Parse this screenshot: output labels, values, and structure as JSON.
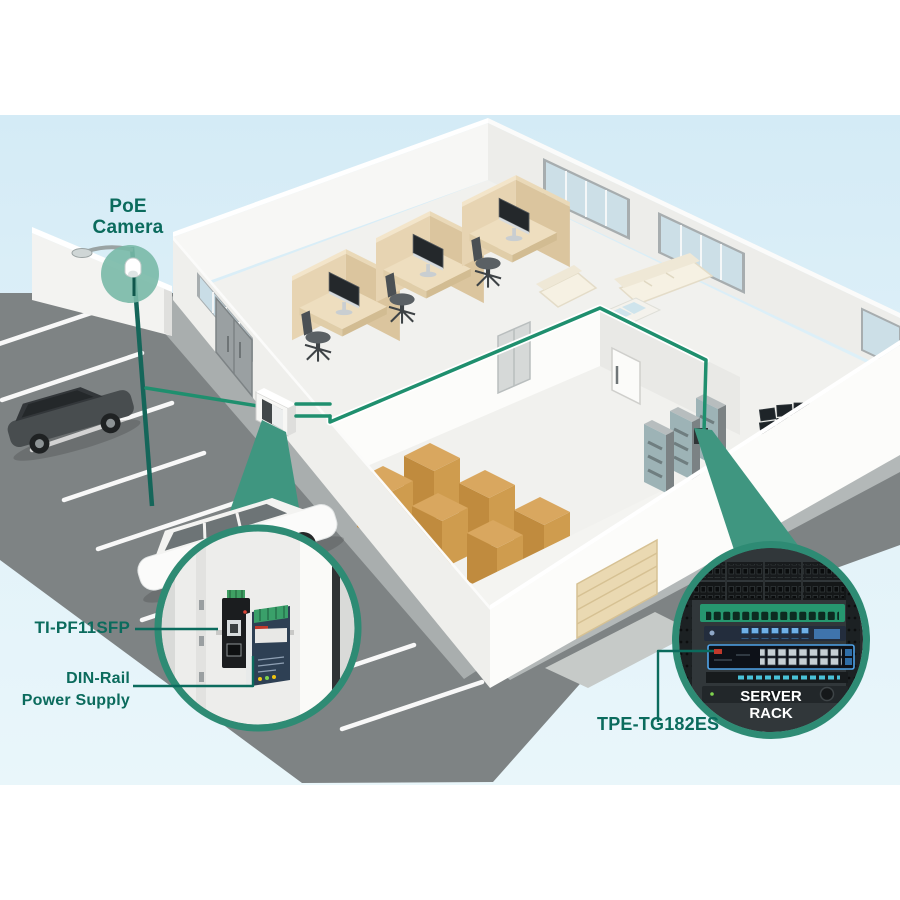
{
  "labels": {
    "camera": {
      "line1": "PoE",
      "line2": "Camera"
    },
    "fiber_converter": "TI-PF11SFP",
    "power_supply": {
      "line1": "DIN-Rail",
      "line2": "Power Supply"
    },
    "switch": "TPE-TG182ES",
    "rack": {
      "line1": "SERVER",
      "line2": "RACK"
    }
  },
  "colors": {
    "accent_cable": "#1f8f6e",
    "label_text": "#0b6b5d",
    "callout_ring": "#2e8b74",
    "cone": "#3f9680",
    "camera_halo": "#79b9a7",
    "sky": "#d8eef7",
    "street": "#7e8384",
    "carton_box": "#cf9c4e",
    "cubicle_panel": "#e7d4b2",
    "switch_highlight": "#4fa3e8",
    "rack_patch_green": "#26976f"
  },
  "icons": {
    "camera": "dome-camera-icon",
    "converter": "fiber-media-converter-icon",
    "psu": "din-rail-power-supply-icon",
    "rack": "server-rack-icon"
  },
  "scene_objects": [
    "parking lot with cars",
    "street lamp with PoE camera",
    "office cubicles",
    "lounge furniture",
    "warehouse boxes",
    "server cabinets",
    "control desk with monitor wall",
    "wall mounted fiber box",
    "din-rail enclosure callout",
    "server rack callout"
  ]
}
